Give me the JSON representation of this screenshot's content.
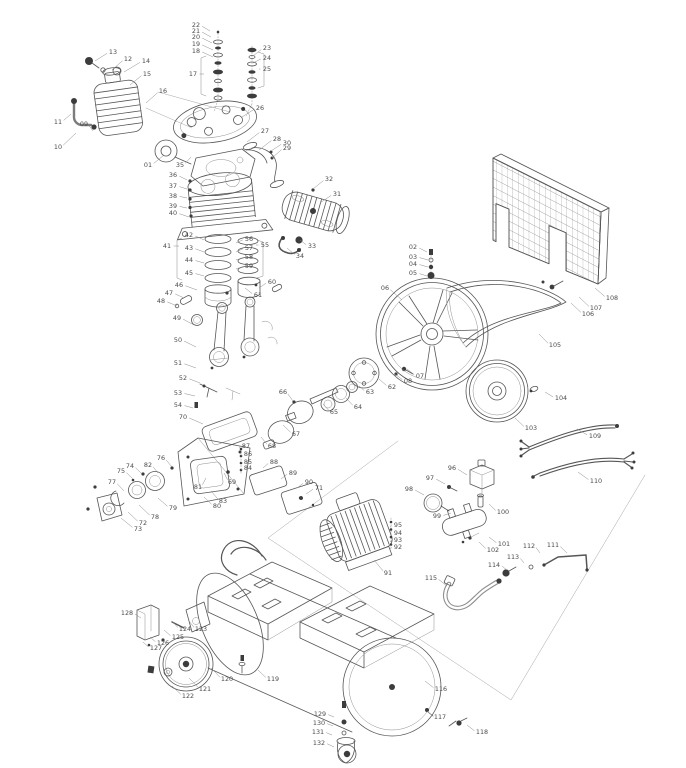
{
  "diagram": {
    "type": "exploded-parts-diagram",
    "subject": "belt-driven air compressor parts diagram",
    "background_color": "#ffffff",
    "line_color": "#565656",
    "label_color": "#4a4a4a",
    "label_fields": [
      "part_number",
      "label_x",
      "label_y",
      "leader_x",
      "leader_y"
    ],
    "labels": [
      [
        "01",
        148,
        165,
        163,
        156
      ],
      [
        "02",
        413,
        247,
        427,
        252
      ],
      [
        "03",
        413,
        257,
        428,
        260
      ],
      [
        "04",
        413,
        264,
        428,
        267
      ],
      [
        "05",
        413,
        273,
        427,
        276
      ],
      [
        "06",
        385,
        288,
        402,
        300
      ],
      [
        "07",
        420,
        376,
        407,
        369
      ],
      [
        "08",
        408,
        381,
        395,
        374
      ],
      [
        "09",
        84,
        124,
        93,
        131
      ],
      [
        "10",
        58,
        147,
        76,
        133
      ],
      [
        "11",
        58,
        122,
        71,
        114
      ],
      [
        "12",
        128,
        59,
        112,
        70
      ],
      [
        "13",
        113,
        52,
        95,
        61
      ],
      [
        "14",
        146,
        61,
        124,
        72
      ],
      [
        "15",
        147,
        74,
        130,
        85
      ],
      [
        "16",
        163,
        91,
        146,
        103
      ],
      [
        "17",
        193,
        74,
        204,
        74
      ],
      [
        "18",
        196,
        51,
        213,
        57
      ],
      [
        "19",
        196,
        44,
        213,
        50
      ],
      [
        "20",
        196,
        37,
        212,
        43
      ],
      [
        "21",
        196,
        31,
        211,
        37
      ],
      [
        "22",
        196,
        25,
        210,
        31
      ],
      [
        "23",
        267,
        48,
        253,
        56
      ],
      [
        "24",
        267,
        58,
        253,
        63
      ],
      [
        "25",
        267,
        69,
        259,
        69
      ],
      [
        "26",
        260,
        108,
        242,
        117
      ],
      [
        "27",
        265,
        131,
        247,
        142
      ],
      [
        "28",
        277,
        139,
        259,
        150
      ],
      [
        "29",
        287,
        148,
        272,
        158
      ],
      [
        "30",
        287,
        143,
        271,
        151
      ],
      [
        "31",
        337,
        194,
        320,
        203
      ],
      [
        "32",
        329,
        179,
        313,
        189
      ],
      [
        "33",
        312,
        246,
        300,
        240
      ],
      [
        "34",
        300,
        256,
        287,
        248
      ],
      [
        "35",
        180,
        165,
        191,
        157
      ],
      [
        "36",
        173,
        175,
        187,
        180
      ],
      [
        "37",
        173,
        186,
        187,
        189
      ],
      [
        "38",
        173,
        196,
        187,
        198
      ],
      [
        "39",
        173,
        206,
        187,
        208
      ],
      [
        "40",
        173,
        213,
        189,
        217
      ],
      [
        "41",
        167,
        246,
        179,
        246
      ],
      [
        "42",
        189,
        235,
        204,
        240
      ],
      [
        "43",
        189,
        248,
        204,
        252
      ],
      [
        "44",
        189,
        260,
        204,
        263
      ],
      [
        "45",
        189,
        273,
        204,
        276
      ],
      [
        "46",
        179,
        285,
        197,
        290
      ],
      [
        "47",
        169,
        293,
        184,
        298
      ],
      [
        "48",
        161,
        301,
        177,
        306
      ],
      [
        "49",
        177,
        318,
        194,
        325
      ],
      [
        "50",
        178,
        340,
        196,
        347
      ],
      [
        "51",
        178,
        363,
        196,
        368
      ],
      [
        "52",
        183,
        378,
        200,
        383
      ],
      [
        "53",
        178,
        393,
        195,
        396
      ],
      [
        "54",
        178,
        405,
        193,
        408
      ],
      [
        "55",
        265,
        245,
        256,
        245
      ],
      [
        "56",
        249,
        239,
        236,
        243
      ],
      [
        "57",
        249,
        248,
        236,
        252
      ],
      [
        "58",
        249,
        257,
        236,
        260
      ],
      [
        "59",
        249,
        266,
        236,
        269
      ],
      [
        "60",
        272,
        282,
        259,
        288
      ],
      [
        "61",
        258,
        295,
        245,
        288
      ],
      [
        "62",
        392,
        387,
        379,
        379
      ],
      [
        "63",
        370,
        392,
        359,
        386
      ],
      [
        "64",
        358,
        407,
        346,
        398
      ],
      [
        "65",
        334,
        412,
        323,
        404
      ],
      [
        "66",
        283,
        392,
        293,
        401
      ],
      [
        "67",
        296,
        434,
        283,
        425
      ],
      [
        "68",
        272,
        446,
        261,
        437
      ],
      [
        "69",
        232,
        482,
        224,
        473
      ],
      [
        "70",
        183,
        417,
        203,
        424
      ],
      [
        "71",
        319,
        488,
        306,
        494
      ],
      [
        "72",
        143,
        523,
        128,
        512
      ],
      [
        "73",
        138,
        529,
        121,
        518
      ],
      [
        "74",
        130,
        466,
        142,
        474
      ],
      [
        "75",
        121,
        471,
        133,
        479
      ],
      [
        "76",
        161,
        458,
        172,
        467
      ],
      [
        "77",
        112,
        482,
        124,
        491
      ],
      [
        "78",
        155,
        517,
        139,
        505
      ],
      [
        "79",
        173,
        508,
        158,
        498
      ],
      [
        "80",
        217,
        506,
        204,
        497
      ],
      [
        "81",
        198,
        487,
        206,
        478
      ],
      [
        "82",
        148,
        465,
        158,
        473
      ],
      [
        "83",
        223,
        501,
        211,
        491
      ],
      [
        "84",
        248,
        468,
        241,
        470
      ],
      [
        "85",
        248,
        462,
        241,
        463
      ],
      [
        "86",
        248,
        454,
        241,
        456
      ],
      [
        "87",
        246,
        446,
        239,
        448
      ],
      [
        "88",
        274,
        462,
        263,
        468
      ],
      [
        "89",
        293,
        473,
        281,
        479
      ],
      [
        "90",
        309,
        482,
        297,
        488
      ],
      [
        "91",
        388,
        573,
        374,
        560
      ],
      [
        "92",
        398,
        547,
        390,
        549
      ],
      [
        "93",
        398,
        540,
        390,
        542
      ],
      [
        "94",
        398,
        533,
        390,
        535
      ],
      [
        "95",
        398,
        525,
        390,
        527
      ],
      [
        "96",
        452,
        468,
        467,
        475
      ],
      [
        "97",
        430,
        478,
        445,
        484
      ],
      [
        "98",
        409,
        489,
        424,
        495
      ],
      [
        "99",
        437,
        516,
        451,
        513
      ],
      [
        "100",
        503,
        512,
        489,
        504
      ],
      [
        "101",
        504,
        544,
        489,
        537
      ],
      [
        "102",
        493,
        550,
        479,
        542
      ],
      [
        "103",
        531,
        428,
        515,
        418
      ],
      [
        "104",
        561,
        398,
        545,
        392
      ],
      [
        "105",
        555,
        345,
        539,
        334
      ],
      [
        "106",
        588,
        314,
        571,
        303
      ],
      [
        "107",
        596,
        308,
        579,
        297
      ],
      [
        "108",
        612,
        298,
        595,
        288
      ],
      [
        "109",
        595,
        436,
        577,
        429
      ],
      [
        "110",
        596,
        481,
        578,
        472
      ],
      [
        "111",
        553,
        545,
        567,
        553
      ],
      [
        "112",
        529,
        546,
        540,
        553
      ],
      [
        "113",
        513,
        557,
        524,
        563
      ],
      [
        "114",
        494,
        565,
        507,
        570
      ],
      [
        "115",
        431,
        578,
        447,
        586
      ],
      [
        "116",
        441,
        689,
        425,
        681
      ],
      [
        "117",
        440,
        717,
        427,
        711
      ],
      [
        "118",
        482,
        732,
        467,
        725
      ],
      [
        "119",
        273,
        679,
        258,
        670
      ],
      [
        "120",
        227,
        679,
        211,
        668
      ],
      [
        "121",
        205,
        689,
        189,
        678
      ],
      [
        "122",
        188,
        696,
        172,
        686
      ],
      [
        "123",
        201,
        629,
        189,
        621
      ],
      [
        "124",
        185,
        629,
        173,
        622
      ],
      [
        "125",
        178,
        637,
        164,
        630
      ],
      [
        "126",
        163,
        643,
        150,
        637
      ],
      [
        "127",
        156,
        648,
        143,
        642
      ],
      [
        "128",
        127,
        613,
        141,
        618
      ],
      [
        "129",
        320,
        714,
        334,
        717
      ],
      [
        "130",
        319,
        723,
        333,
        726
      ],
      [
        "131",
        318,
        732,
        332,
        735
      ],
      [
        "132",
        319,
        743,
        334,
        747
      ]
    ]
  }
}
